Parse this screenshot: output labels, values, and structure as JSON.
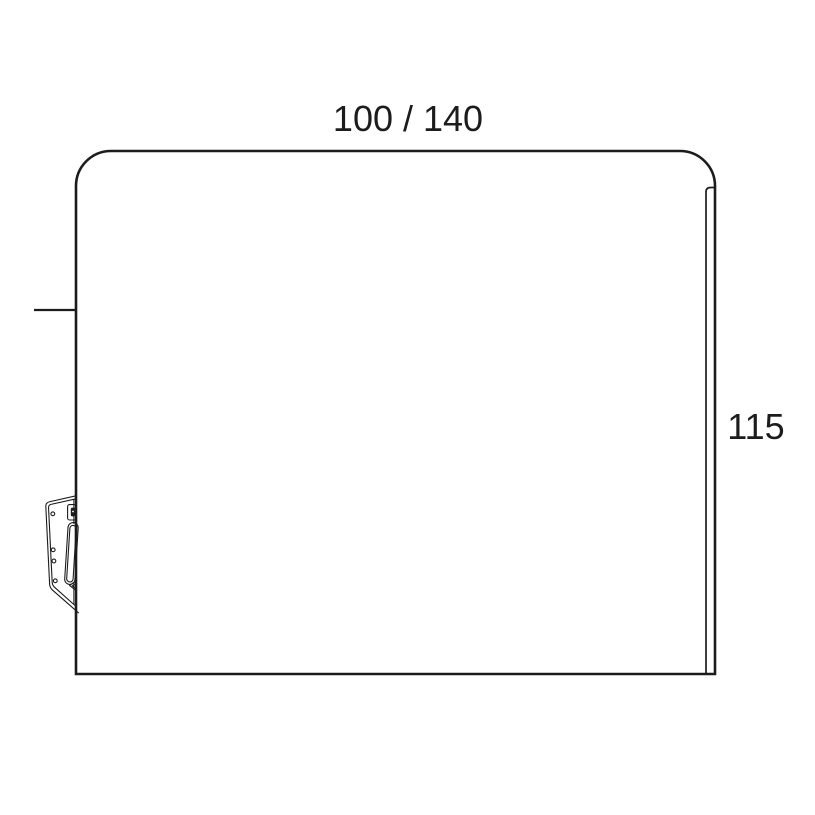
{
  "drawing": {
    "kind_label": "",
    "dimensions": {
      "top_width_label": "100 / 140",
      "right_height_label": "115"
    },
    "colors": {
      "line": "#1c1c1c",
      "background": "#ffffff"
    }
  }
}
